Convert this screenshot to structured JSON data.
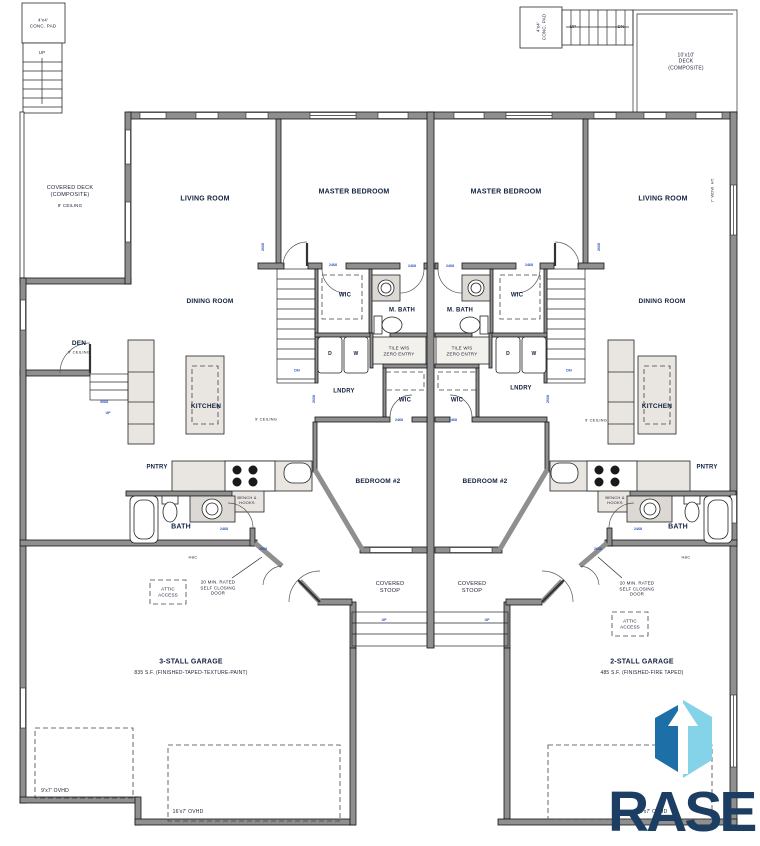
{
  "site": {
    "conc_pad_left": "4'x4'\nCONC. PAD",
    "conc_pad_right": "4'x4'\nCONC. PAD",
    "stairs_left_up": "UP",
    "stairs_right_up": "UP",
    "stairs_right_dn": "DN",
    "covered_deck": "COVERED DECK\n(COMPOSITE)",
    "covered_deck_ceiling": "9' CEILING",
    "deck_right": "10'x10'\nDECK\n(COMPOSITE)",
    "window_note": "7' WDW. HT."
  },
  "unit_left": {
    "living_room": "LIVING ROOM",
    "master_bedroom": "MASTER BEDROOM",
    "dining_room": "DINING ROOM",
    "den": "DEN",
    "den_ceiling": "9' CEILING",
    "wic": "WIC",
    "m_bath": "M. BATH",
    "shower": "TILE W/S\nZERO ENTRY",
    "lndry": "LNDRY",
    "hall_wic": "WIC",
    "stairs_dn": "DN",
    "ceiling": "9' CEILING",
    "kitchen": "KITCHEN",
    "pntry": "PNTRY",
    "bench": "BENCH &\nHOOKS",
    "bath": "BATH",
    "hc": "H&C",
    "attic": "ATTIC\nACCESS",
    "rated_door": "20 MIN. RATED\nSELF CLOSING\nDOOR",
    "bedroom2": "BEDROOM #2",
    "stoop": "COVERED\nSTOOP",
    "stoop_up": "UP",
    "den_up": "UP",
    "dryer": "D",
    "washer": "W"
  },
  "unit_right": {
    "living_room": "LIVING ROOM",
    "master_bedroom": "MASTER BEDROOM",
    "dining_room": "DINING ROOM",
    "wic": "WIC",
    "m_bath": "M. BATH",
    "shower": "TILE W/S\nZERO ENTRY",
    "lndry": "LNDRY",
    "hall_wic": "WIC",
    "stairs_dn": "DN",
    "ceiling": "9' CEILING",
    "kitchen": "KITCHEN",
    "pntry": "PNTRY",
    "bench": "BENCH &\nHOOKS",
    "bath": "BATH",
    "hc": "H&C",
    "attic": "ATTIC\nACCESS",
    "rated_door": "20 MIN. RATED\nSELF CLOSING\nDOOR",
    "bedroom2": "BEDROOM #2",
    "stoop": "COVERED\nSTOOP",
    "stoop_up": "UP",
    "dryer": "D",
    "washer": "W"
  },
  "garage_left": {
    "title": "3-STALL GARAGE",
    "area": "835 S.F. (FINISHED-TAPED-TEXTURE-PAINT)",
    "door_small": "9'x7' OVHD",
    "door_large": "16'x7' OVHD"
  },
  "garage_right": {
    "title": "2-STALL GARAGE",
    "area": "485 S.F. (FINISHED-FIRE TAPED)",
    "door_large": "16'x7' OVHD"
  },
  "door_tags": [
    "2468",
    "2468",
    "2468",
    "2468",
    "2668",
    "2668",
    "2468",
    "2468",
    "3068",
    "2468",
    "2468",
    "2668",
    "2668",
    "2668",
    "2668"
  ],
  "logo": {
    "text": "RASE",
    "navy": "#1c3e63",
    "blue": "#1d6fa8",
    "light_blue": "#85d3e8"
  }
}
